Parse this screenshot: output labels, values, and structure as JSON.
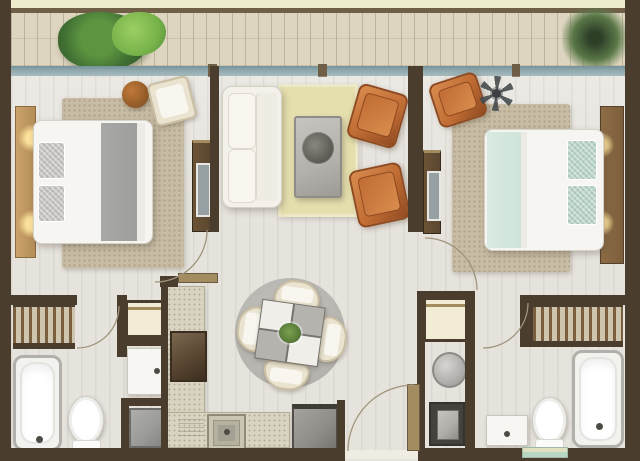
{
  "image_type": "rendered apartment floor plan, top-down view, no text labels",
  "palette": {
    "outside": "#ecebcb",
    "rail": "#6f5f47",
    "wall": "#4a3d2e",
    "jamb": "#a38c5f",
    "deck": "#ddd5bf",
    "window": "#8fa9ad",
    "floor": "#e6e3dd",
    "rugTan": "#c8bca5",
    "rugYellow": "#e5dfae",
    "rugGray": "#b6b4af",
    "sofaWhite": "#f3f1ea",
    "orange": "#c06c34",
    "orangeDark": "#8f4a20",
    "orangeLight": "#d98c4d",
    "tableGray": "#b3b1ac",
    "tableBorder": "#8f8d88",
    "medallion": "#57544e",
    "counter": "#d8d4c1",
    "stoveDark": "#3a2d1f",
    "fridge": "#8f8d89",
    "cream": "#f2ecd4",
    "white": "#f6f5f1",
    "blanket": "#9e9e9c",
    "pillowGray": "#c4c3c1",
    "mint": "#cfe4da",
    "mintPillow": "#b7d4c7",
    "headboard1": "#b58e58",
    "headboard2": "#7d5f3c",
    "woodDark": "#5a4630",
    "bushDark": "#3f6e33",
    "bushLight": "#77b24a",
    "bushOlive": "#5a7848",
    "fan": "#4b5052",
    "tub": "#f2f2ee",
    "fixtureBorder": "#b2b0ab",
    "washer": "#9a9a96",
    "applianceDark": "#45423e",
    "applianceScreen": "#aeaca7",
    "closetBg": "#cfc5ae",
    "closetStripe": "#7a5f3e",
    "tealMat": "#b9d6c4",
    "arc": "#a1947c",
    "chairCream": "#e9e3cf",
    "plantGreen": "#5a7d3a",
    "doorLeaf": "#a38c5f"
  },
  "rooms": [
    {
      "name": "balcony",
      "items": [
        "wood-deck",
        "plant-left",
        "plant-right",
        "glass-window-wall"
      ]
    },
    {
      "name": "bedroom-left",
      "items": [
        "double-bed",
        "gray-pillows",
        "headboard-lamps",
        "area-rug",
        "pouf",
        "accent-chair",
        "tv-cabinet"
      ]
    },
    {
      "name": "living-room",
      "items": [
        "white-sofa",
        "yellow-rug",
        "coffee-table",
        "orange-armchair",
        "orange-armchair"
      ]
    },
    {
      "name": "bedroom-right",
      "items": [
        "double-bed",
        "mint-pillows",
        "headboard-lamps",
        "area-rug",
        "orange-armchair",
        "ceiling-fan",
        "tv-cabinet"
      ]
    },
    {
      "name": "kitchen",
      "items": [
        "l-shaped-counter",
        "cooktop",
        "sink",
        "refrigerator"
      ]
    },
    {
      "name": "dining",
      "items": [
        "round-rug",
        "checkered-table",
        "four-chairs",
        "centerpiece-plant"
      ]
    },
    {
      "name": "bathroom-left",
      "items": [
        "wardrobe-closet",
        "bathtub",
        "toilet",
        "vanity-sink",
        "washer",
        "storage-cabinet"
      ]
    },
    {
      "name": "bathroom-right",
      "items": [
        "wardrobe-closet",
        "bathtub",
        "toilet",
        "vanity-sink",
        "round-washer",
        "appliance",
        "bath-mat",
        "storage-cabinet"
      ]
    },
    {
      "name": "entry",
      "items": [
        "entry-door-leaf",
        "door-swing-arc"
      ]
    }
  ],
  "door_arcs_count": 5
}
